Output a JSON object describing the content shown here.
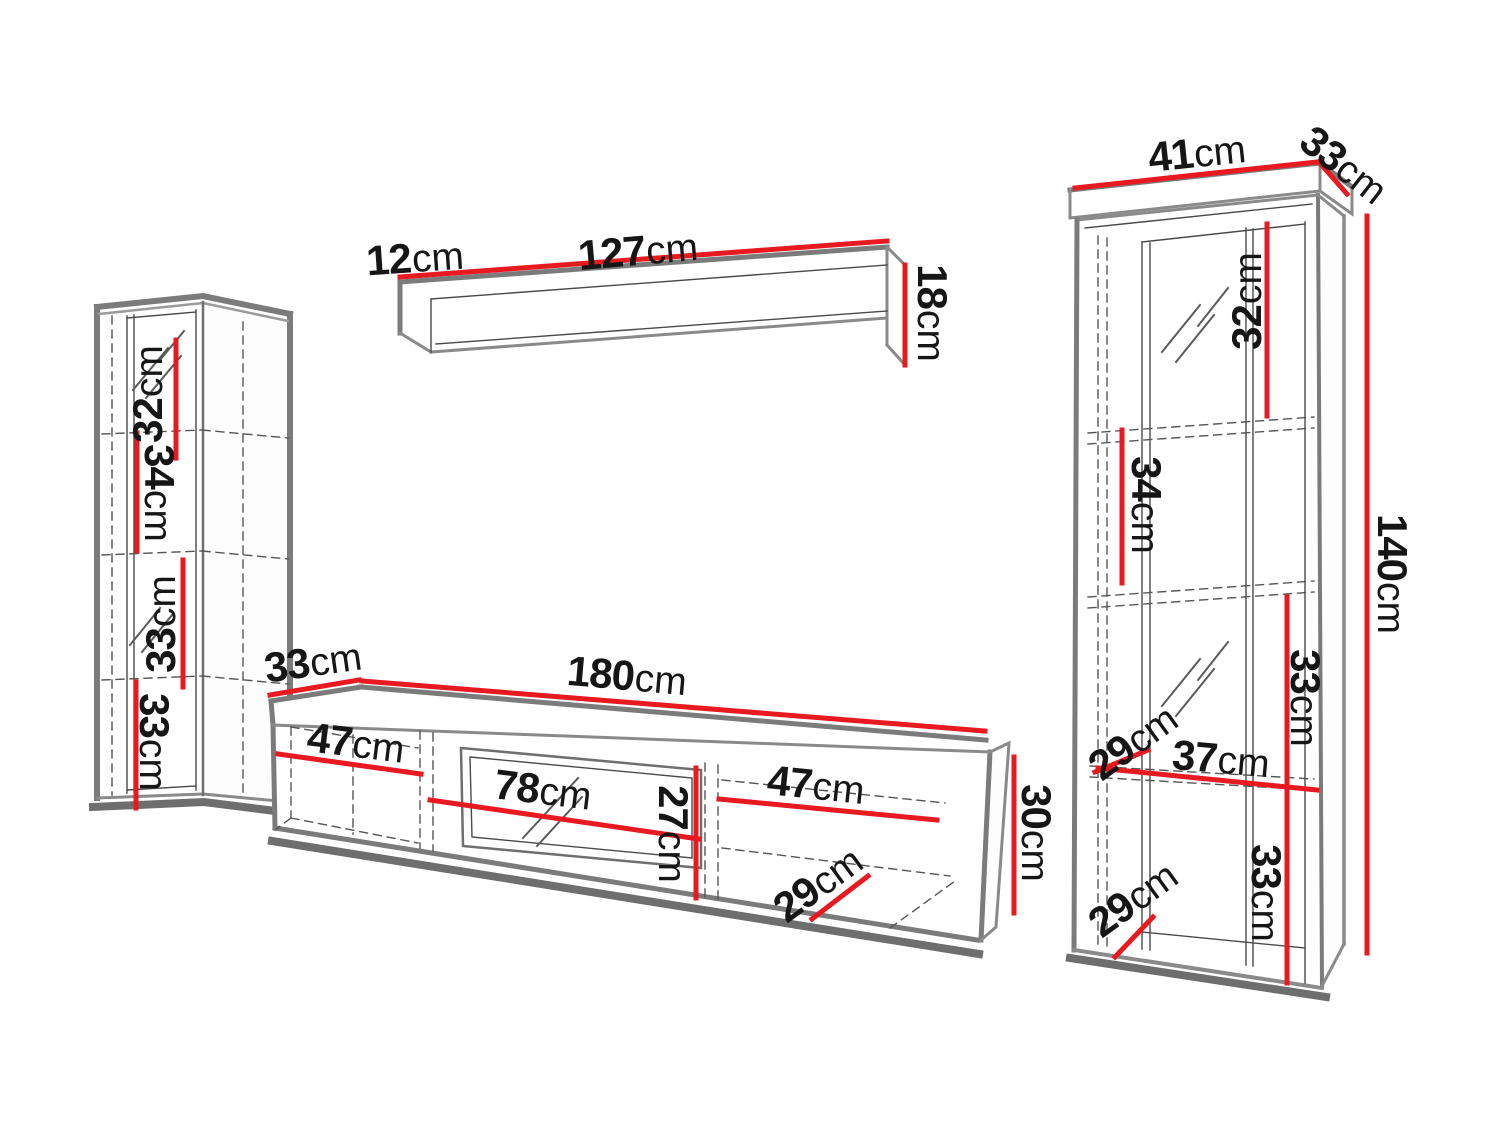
{
  "figure": {
    "kind": "furniture dimension diagram",
    "description": "Wall unit set: wall shelf, two display cabinets and TV stand with dimension lines"
  },
  "colors": {
    "dimension_line": "#e8191f",
    "outline": "#7b7b7b",
    "detail_line": "#4a4a4a"
  },
  "pieces": {
    "wall_shelf": {
      "name": "Wall shelf",
      "dims": {
        "depth": {
          "v": "12",
          "u": "cm"
        },
        "length": {
          "v": "127",
          "u": "cm"
        },
        "height": {
          "v": "18",
          "u": "cm"
        }
      }
    },
    "left_cabinet": {
      "name": "Left display cabinet",
      "dims": {
        "section1_height": {
          "v": "32",
          "u": "cm"
        },
        "section2_height": {
          "v": "34",
          "u": "cm"
        },
        "section3_height": {
          "v": "33",
          "u": "cm"
        },
        "section4_height": {
          "v": "33",
          "u": "cm"
        }
      }
    },
    "tv_stand": {
      "name": "TV stand",
      "dims": {
        "depth": {
          "v": "33",
          "u": "cm"
        },
        "width": {
          "v": "180",
          "u": "cm"
        },
        "left_compartment_width": {
          "v": "47",
          "u": "cm"
        },
        "middle_compartment_width": {
          "v": "78",
          "u": "cm"
        },
        "middle_compartment_height": {
          "v": "27",
          "u": "cm"
        },
        "right_compartment_width": {
          "v": "47",
          "u": "cm"
        },
        "inner_depth": {
          "v": "29",
          "u": "cm"
        },
        "height": {
          "v": "30",
          "u": "cm"
        }
      }
    },
    "right_cabinet": {
      "name": "Right display cabinet",
      "dims": {
        "top_width": {
          "v": "41",
          "u": "cm"
        },
        "top_depth": {
          "v": "33",
          "u": "cm"
        },
        "section1_height": {
          "v": "32",
          "u": "cm"
        },
        "section2_height": {
          "v": "34",
          "u": "cm"
        },
        "section3_height": {
          "v": "33",
          "u": "cm"
        },
        "section4_height": {
          "v": "33",
          "u": "cm"
        },
        "shelf_depth_middle": {
          "v": "29",
          "u": "cm"
        },
        "inner_width": {
          "v": "37",
          "u": "cm"
        },
        "shelf_depth_bottom": {
          "v": "29",
          "u": "cm"
        },
        "total_height": {
          "v": "140",
          "u": "cm"
        }
      }
    }
  }
}
